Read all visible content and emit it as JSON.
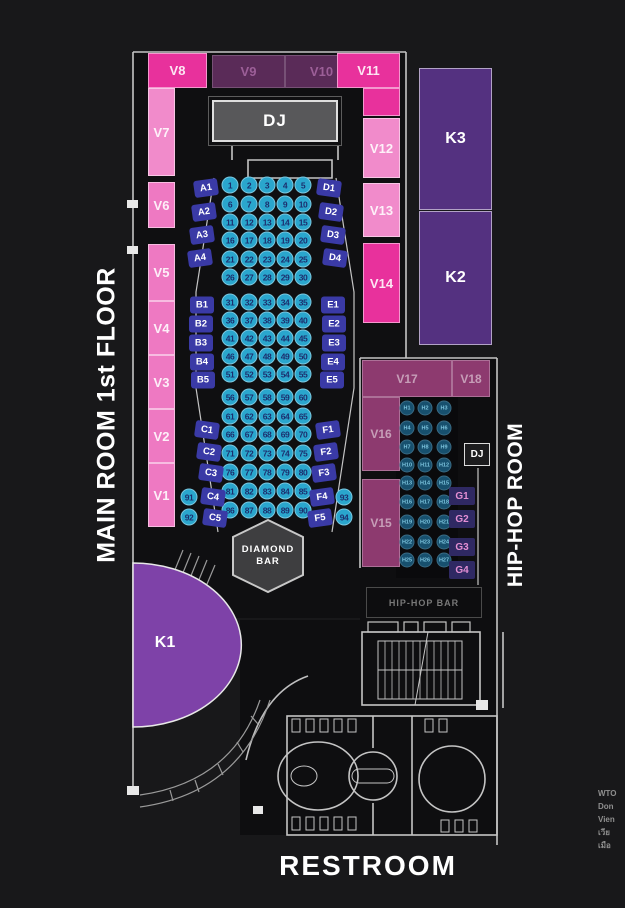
{
  "titles": {
    "main": "MAIN ROOM 1st FLOOR",
    "hiphop": "HIP-HOP ROOM",
    "restroom": "RESTROOM"
  },
  "labels": {
    "dj_main": "DJ",
    "dj_hiphop": "DJ",
    "diamond_bar": "DIAMOND BAR",
    "hiphop_bar": "HIP-HOP BAR"
  },
  "karaoke": {
    "k1": "K1",
    "k2": "K2",
    "k3": "K3"
  },
  "main_room": {
    "vip_tables": [
      {
        "id": "V1",
        "variant": "pink"
      },
      {
        "id": "V2",
        "variant": "pink"
      },
      {
        "id": "V3",
        "variant": "pink"
      },
      {
        "id": "V4",
        "variant": "pink"
      },
      {
        "id": "V5",
        "variant": "pink"
      },
      {
        "id": "V6",
        "variant": "pink"
      },
      {
        "id": "V7",
        "variant": "light"
      },
      {
        "id": "V8",
        "variant": "hot"
      },
      {
        "id": "V9",
        "variant": "dark"
      },
      {
        "id": "V10",
        "variant": "dark"
      },
      {
        "id": "V11",
        "variant": "hot"
      },
      {
        "id": "V12",
        "variant": "light"
      },
      {
        "id": "V13",
        "variant": "light"
      },
      {
        "id": "V14",
        "variant": "hot"
      }
    ],
    "sofas": [
      "A1",
      "A2",
      "A3",
      "A4",
      "B1",
      "B2",
      "B3",
      "B4",
      "B5",
      "C1",
      "C2",
      "C3",
      "C4",
      "C5",
      "D1",
      "D2",
      "D3",
      "D4",
      "E1",
      "E2",
      "E3",
      "E4",
      "E5",
      "F1",
      "F2",
      "F3",
      "F4",
      "F5"
    ],
    "seat_rows": [
      [
        "1",
        "2",
        "3",
        "4",
        "5"
      ],
      [
        "6",
        "7",
        "8",
        "9",
        "10"
      ],
      [
        "11",
        "12",
        "13",
        "14",
        "15"
      ],
      [
        "16",
        "17",
        "18",
        "19",
        "20"
      ],
      [
        "21",
        "22",
        "23",
        "24",
        "25"
      ],
      [
        "26",
        "27",
        "28",
        "29",
        "30"
      ],
      [
        "31",
        "32",
        "33",
        "34",
        "35"
      ],
      [
        "36",
        "37",
        "38",
        "39",
        "40"
      ],
      [
        "41",
        "42",
        "43",
        "44",
        "45"
      ],
      [
        "46",
        "47",
        "48",
        "49",
        "50"
      ],
      [
        "51",
        "52",
        "53",
        "54",
        "55"
      ],
      [
        "56",
        "57",
        "58",
        "59",
        "60"
      ],
      [
        "61",
        "62",
        "63",
        "64",
        "65"
      ],
      [
        "66",
        "67",
        "68",
        "69",
        "70"
      ],
      [
        "71",
        "72",
        "73",
        "74",
        "75"
      ],
      [
        "76",
        "77",
        "78",
        "79",
        "80"
      ],
      [
        "81",
        "82",
        "83",
        "84",
        "85"
      ],
      [
        "86",
        "87",
        "88",
        "89",
        "90"
      ]
    ],
    "side_seats": [
      "91",
      "92",
      "93",
      "94"
    ]
  },
  "hiphop_room": {
    "vip_tables": [
      {
        "id": "V15",
        "variant": "plum"
      },
      {
        "id": "V16",
        "variant": "plum"
      },
      {
        "id": "V17",
        "variant": "plum"
      },
      {
        "id": "V18",
        "variant": "plum"
      }
    ],
    "seat_rows": [
      [
        "H1",
        "H2",
        "H3"
      ],
      [
        "H4",
        "H5",
        "H6"
      ],
      [
        "H7",
        "H8",
        "H9"
      ],
      [
        "H10",
        "H11",
        "H12"
      ],
      [
        "H13",
        "H14",
        "H15"
      ],
      [
        "H16",
        "H17",
        "H18"
      ],
      [
        "H19",
        "H20",
        "H21"
      ],
      [
        "H22",
        "H23",
        "H24"
      ],
      [
        "H25",
        "H26",
        "H27"
      ]
    ],
    "g_tables": [
      "G1",
      "G2",
      "G3",
      "G4"
    ]
  },
  "footer": {
    "lines": [
      "WTO",
      "Don",
      "Vien",
      "เวีย",
      "เมือ"
    ]
  },
  "colors": {
    "hot_pink": "#e8319c",
    "light_pink": "#f18bcb",
    "pink": "#ee79c2",
    "plum": "#8d3a6f",
    "karaoke_purple": "#543180",
    "k1_purple": "#7e42a8",
    "seat_fill": "#2aa6cd",
    "seat_text": "#1c2f6e",
    "sofa_fill": "#3a3aa6",
    "h_seat_fill": "#17506e",
    "h_seat_text": "#7cc4de",
    "g_fill": "#2f2963",
    "g_text": "#e48fd4",
    "dj_fill": "#58585a",
    "v9_fill": "#5a2b58",
    "v9_text": "#9c5f98",
    "wall": "#d4d4d4"
  }
}
